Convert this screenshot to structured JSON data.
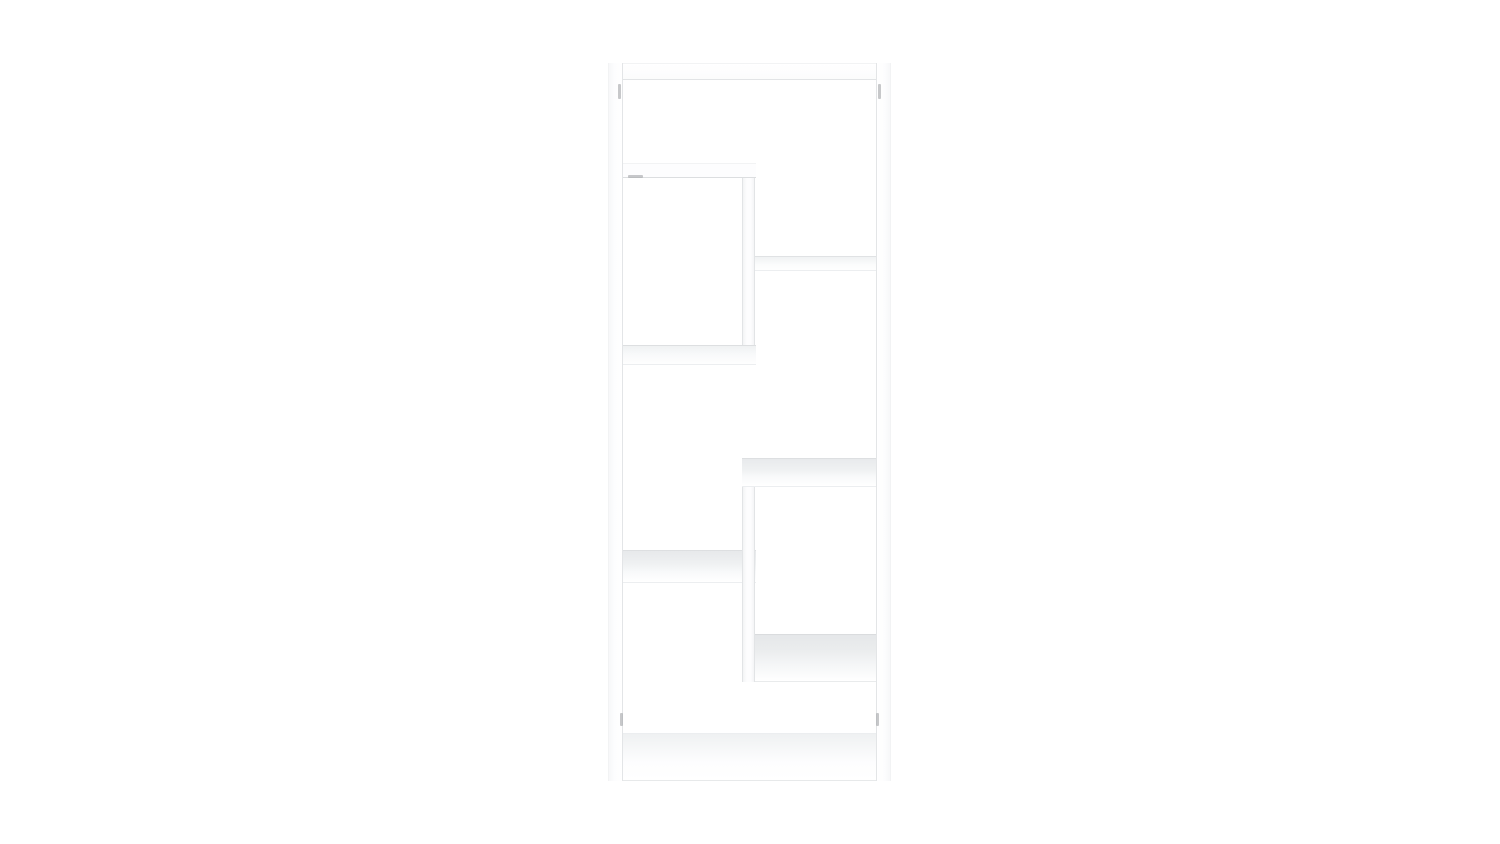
{
  "subject": {
    "type": "bookshelf-product-photo",
    "description": "White freestanding bookcase with eight staggered open compartments on a plain white background",
    "color_name": "white",
    "compartment_count": 8
  },
  "palette": {
    "bg": "#ffffff",
    "face": "#fdfdfe",
    "edge": "#dddfe1",
    "edge-soft": "#eceef0",
    "hairline": "#f2f3f4",
    "shade1": "#e5e7e9",
    "shade2": "#eff1f2",
    "shade3": "#f8f9fa",
    "pin": "#a9abad"
  },
  "scene": {
    "planks": [
      {
        "id": "bookshelf-top-panel",
        "style": "s-top",
        "x": 608,
        "y": 63,
        "w": 283,
        "h": 17
      },
      {
        "id": "bookshelf-bottom-panel",
        "style": "s-bottom",
        "x": 608,
        "y": 733,
        "w": 283,
        "h": 48
      },
      {
        "id": "bookshelf-left-side-panel",
        "style": "s-wall-left",
        "x": 608,
        "y": 63,
        "w": 15,
        "h": 718
      },
      {
        "id": "bookshelf-right-side-panel",
        "style": "s-wall-right",
        "x": 876,
        "y": 63,
        "w": 15,
        "h": 718
      },
      {
        "id": "bookshelf-shelf-right-upper",
        "style": "s-shelf-c",
        "x": 742,
        "y": 256,
        "w": 134,
        "h": 15
      },
      {
        "id": "bookshelf-shelf-left-lower",
        "style": "s-shelf-e",
        "x": 623,
        "y": 550,
        "w": 133,
        "h": 33
      },
      {
        "id": "bookshelf-shelf-right-lower",
        "style": "s-shelf-f",
        "x": 742,
        "y": 634,
        "w": 134,
        "h": 48
      },
      {
        "id": "bookshelf-divider-upper",
        "style": "s-vdiv",
        "x": 742,
        "y": 166,
        "w": 13,
        "h": 196
      },
      {
        "id": "bookshelf-divider-lower",
        "style": "s-vdiv",
        "x": 742,
        "y": 468,
        "w": 13,
        "h": 214
      },
      {
        "id": "bookshelf-shelf-left-upper",
        "style": "s-shelf-a",
        "x": 623,
        "y": 163,
        "w": 133,
        "h": 15
      },
      {
        "id": "bookshelf-shelf-left-middle",
        "style": "s-shelf-b",
        "x": 623,
        "y": 345,
        "w": 133,
        "h": 20
      },
      {
        "id": "bookshelf-shelf-right-middle",
        "style": "s-shelf-d",
        "x": 742,
        "y": 458,
        "w": 134,
        "h": 29
      }
    ],
    "pins": [
      {
        "id": "connector-pin-top-left",
        "x": 618,
        "y": 84,
        "w": 3,
        "h": 15
      },
      {
        "id": "connector-pin-top-right",
        "x": 878,
        "y": 84,
        "w": 3,
        "h": 15
      },
      {
        "id": "connector-pin-bottom-left",
        "x": 620,
        "y": 713,
        "w": 3,
        "h": 13
      },
      {
        "id": "connector-pin-bottom-right",
        "x": 876,
        "y": 713,
        "w": 3,
        "h": 13
      },
      {
        "id": "shelf-joint-shadow-left",
        "x": 628,
        "y": 175,
        "w": 15,
        "h": 3
      }
    ]
  }
}
